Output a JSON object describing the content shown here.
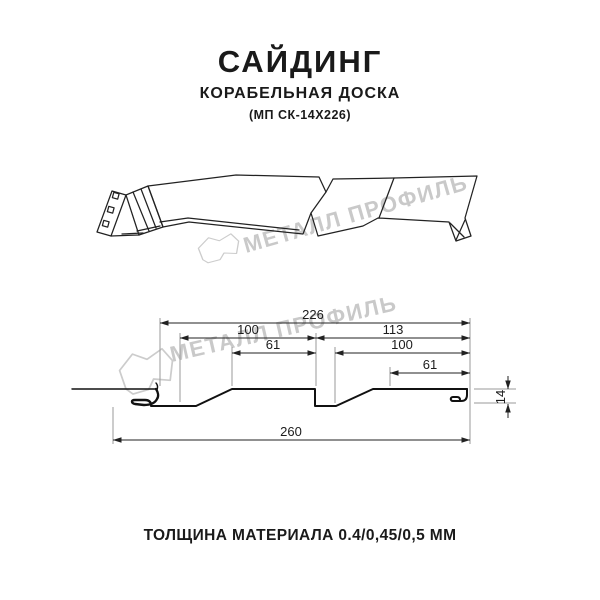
{
  "page": {
    "background": "#ffffff",
    "line_color": "#1a1a1a",
    "watermark_color": "#c9c9c9"
  },
  "header": {
    "title": "САЙДИНГ",
    "subtitle": "КОРАБЕЛЬНАЯ ДОСКА",
    "model": "(МП СК-14Х226)"
  },
  "watermark": {
    "brand": "МЕТАЛЛ ПРОФИЛЬ"
  },
  "diagram": {
    "dimensions": {
      "overall_profile_width": "226",
      "left_board_width": "100",
      "left_board_flat": "61",
      "right_section_width": "113",
      "right_board_width": "100",
      "right_board_flat": "61",
      "total_width": "260",
      "profile_height": "14"
    }
  },
  "footer": {
    "caption": "ТОЛЩИНА МАТЕРИАЛА 0.4/0,45/0,5 ММ"
  }
}
